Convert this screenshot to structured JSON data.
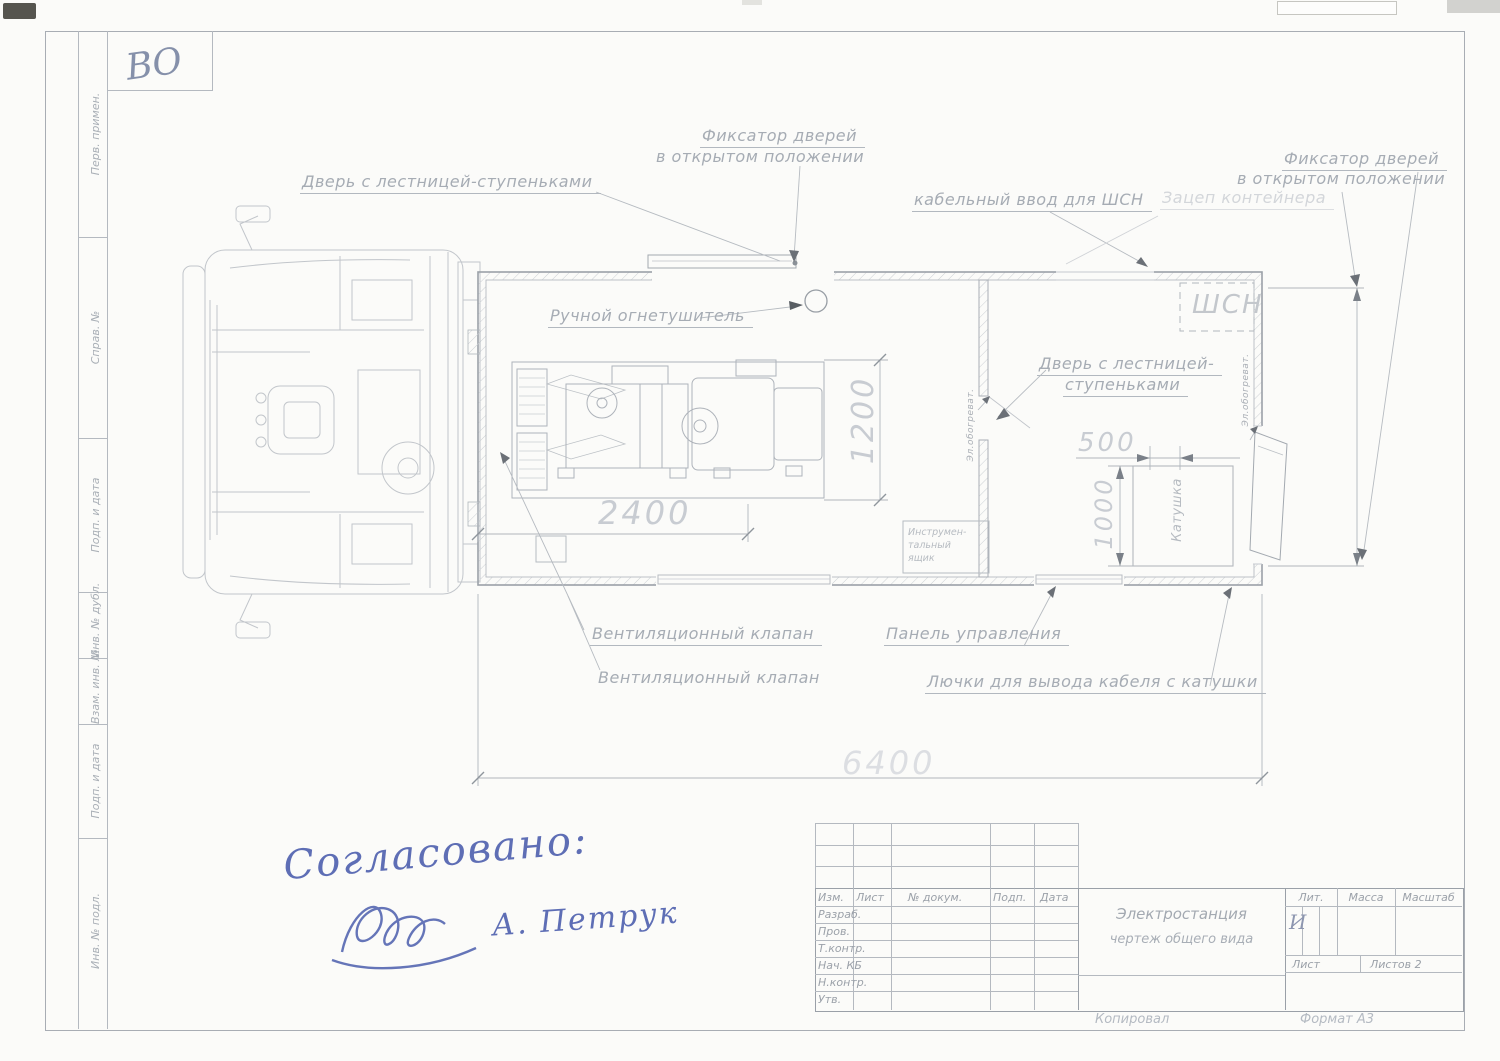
{
  "corner_code": "ВО",
  "sidebar": {
    "labels": [
      "Перв. примен.",
      "Справ. №",
      "Подп. и дата",
      "Инв. № дубл.",
      "Взам. инв. №",
      "Подп. и дата",
      "Инв. № подл."
    ]
  },
  "callouts": {
    "door_left": "Дверь с лестницей-ступеньками",
    "latch_top_line1": "Фиксатор дверей",
    "latch_top_line2": "в открытом положении",
    "cable_entry": "кабельный ввод для ШСН",
    "latch_right_line1": "Фиксатор дверей",
    "latch_right_line2": "в открытом положении",
    "container_hook": "Зацеп контейнера",
    "extinguisher": "Ручной огнетушитель",
    "shsn": "ШСН",
    "door_right_line1": "Дверь с лестницей-",
    "door_right_line2": "ступеньками",
    "heater": "Эл.обогреват.",
    "toolbox_line1": "Инструмен-",
    "toolbox_line2": "тальный",
    "toolbox_line3": "ящик",
    "reel": "Катушка",
    "vent_valve": "Вентиляционный клапан",
    "vent_valve2": "Вентиляционный клапан",
    "control_panel": "Панель управления",
    "cable_hatches": "Лючки для вывода кабеля с катушки"
  },
  "dimensions": {
    "genset_length": "2400",
    "genset_width": "1200",
    "reel_gap": "500",
    "reel_width": "1000",
    "overall_length": "6400"
  },
  "titleblock": {
    "cols": {
      "izm": "Изм.",
      "list": "Лист",
      "doc": "№ докум.",
      "podp": "Подп.",
      "data": "Дата"
    },
    "rows": [
      "Разраб.",
      "Пров.",
      "Т.контр.",
      "Нач. КБ",
      "Н.контр.",
      "Утв."
    ],
    "doc_title": "Электростанция",
    "doc_subtitle": "чертеж общего вида",
    "lit_label": "Лит.",
    "mass_label": "Масса",
    "scale_label": "Масштаб",
    "lit_value": "И",
    "sheet_label": "Лист",
    "sheets_label": "Листов 2",
    "copied_by": "Копировал",
    "format": "Формат А3"
  },
  "approval": {
    "agreed": "Согласовано:",
    "name": "А. Петрук"
  },
  "colors": {
    "ink_blue": "#5e6eb5",
    "pencil_gray": "#aab0b8"
  }
}
